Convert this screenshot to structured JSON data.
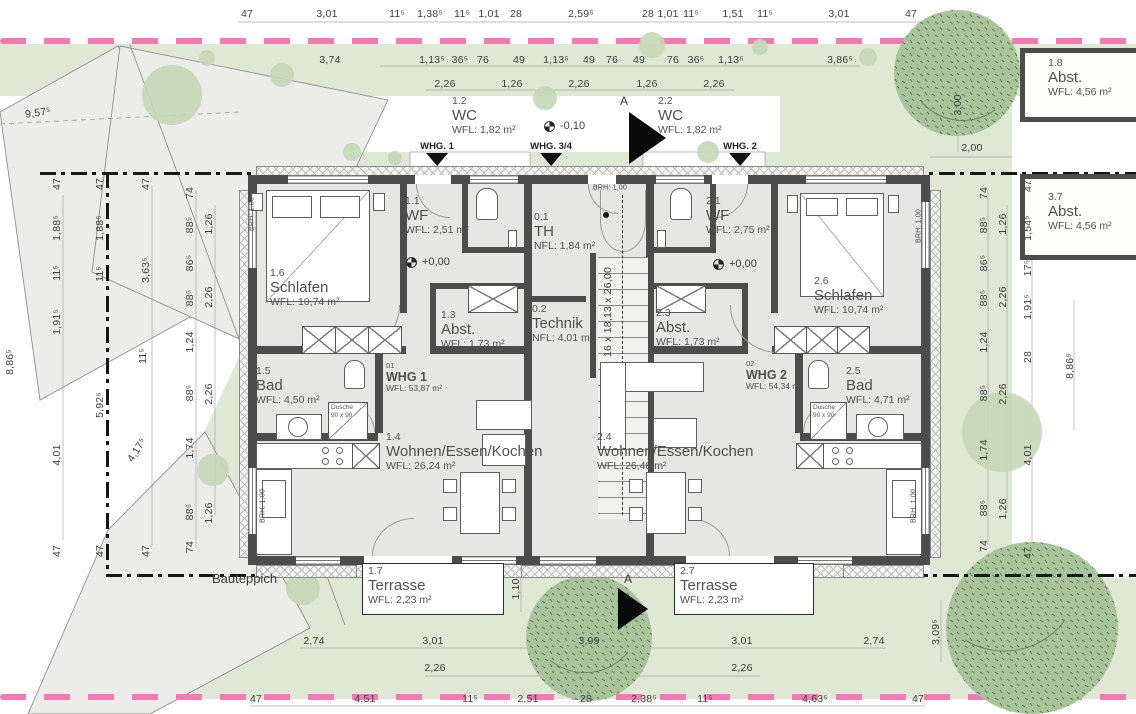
{
  "site": {
    "bauteppich": "Bauteppich",
    "colors": {
      "boundary_pink": "#f479b4",
      "site_green": "#dfe8d5",
      "tree_green": "#a9c49c",
      "wall_gray": "#4c4c4c",
      "floor_gray": "#e6e6e4"
    }
  },
  "stair_note": {
    "t": "16 x 18,13 x 26,00",
    "x": 608,
    "y": 312
  },
  "rooms": [
    {
      "num": "1.2",
      "name": "WC",
      "area": "WFL: 1,82 m²",
      "x": 452,
      "y": 96
    },
    {
      "num": "2.2",
      "name": "WC",
      "area": "WFL: 1,82 m²",
      "x": 658,
      "y": 96
    },
    {
      "num": "1.1",
      "name": "WF",
      "area": "WFL: 2,51 m²",
      "x": 405,
      "y": 196
    },
    {
      "num": "2.1",
      "name": "WF",
      "area": "WFL: 2,75 m²",
      "x": 706,
      "y": 196
    },
    {
      "num": "0.1",
      "name": "TH",
      "area": "NFL: 1,84 m²",
      "x": 534,
      "y": 212
    },
    {
      "num": "1.6",
      "name": "Schlafen",
      "area": "WFL: 10,74 m²",
      "x": 270,
      "y": 268
    },
    {
      "num": "2.6",
      "name": "Schlafen",
      "area": "WFL: 10,74 m²",
      "x": 814,
      "y": 276
    },
    {
      "num": "1.3",
      "name": "Abst.",
      "area": "WFL: 1,73 m²",
      "x": 441,
      "y": 310
    },
    {
      "num": "2.3",
      "name": "Abst.",
      "area": "WFL: 1,73 m²",
      "x": 656,
      "y": 308
    },
    {
      "num": "0.2",
      "name": "Technik",
      "area": "NFL: 4,01 m²",
      "x": 532,
      "y": 304
    },
    {
      "num": "1.5",
      "name": "Bad",
      "area": "WFL: 4,50 m²",
      "x": 256,
      "y": 366
    },
    {
      "num": "2.5",
      "name": "Bad",
      "area": "WFL: 4,71 m²",
      "x": 846,
      "y": 366
    },
    {
      "num": "1.4",
      "name": "Wohnen/Essen/Kochen",
      "area": "WFL: 26,24 m²",
      "x": 386,
      "y": 432
    },
    {
      "num": "2.4",
      "name": "Wohnen/Essen/Kochen",
      "area": "WFL: 26,48 m²",
      "x": 597,
      "y": 432
    },
    {
      "num": "1.7",
      "name": "Terrasse",
      "area": "WFL: 2,23 m²",
      "x": 368,
      "y": 566
    },
    {
      "num": "2.7",
      "name": "Terrasse",
      "area": "WFL: 2,23 m²",
      "x": 680,
      "y": 566
    },
    {
      "num": "1.8",
      "name": "Abst.",
      "area": "WFL: 4,56 m²",
      "x": 1048,
      "y": 58
    },
    {
      "num": "3.7",
      "name": "Abst.",
      "area": "WFL: 4,56 m²",
      "x": 1048,
      "y": 192
    },
    {
      "num": "01",
      "name": "WHG 1",
      "area": "WFL: 53,87 m²",
      "x": 386,
      "y": 362,
      "style": "unit"
    },
    {
      "num": "02",
      "name": "WHG 2",
      "area": "WFL: 54,34 m²",
      "x": 746,
      "y": 360,
      "style": "unit"
    }
  ],
  "benchmarks": [
    {
      "t": "+0,00",
      "x": 406,
      "y": 256
    },
    {
      "t": "+0,00",
      "x": 713,
      "y": 258
    },
    {
      "t": "-0,10",
      "x": 544,
      "y": 120
    }
  ],
  "entries": [
    {
      "t": "WHG. 1",
      "x": 437,
      "y": 141
    },
    {
      "t": "WHG. 3/4",
      "x": 551,
      "y": 141
    },
    {
      "t": "WHG. 2",
      "x": 740,
      "y": 141
    }
  ],
  "sections": [
    {
      "t": "A",
      "x": 620,
      "y": 94,
      "tx": 629,
      "ty": 112,
      "tw": 37,
      "th": 52
    },
    {
      "t": "A",
      "x": 624,
      "y": 572,
      "tx": 618,
      "ty": 588,
      "tw": 30,
      "th": 42
    }
  ],
  "showers": [
    {
      "l1": "Dusche",
      "l2": "90 x 90",
      "x": 328,
      "y": 402,
      "w": 40,
      "h": 38
    },
    {
      "l1": "Dusche",
      "l2": "90 x 90",
      "x": 810,
      "y": 402,
      "w": 37,
      "h": 38
    }
  ],
  "dims": [
    {
      "t": "47",
      "x": 247,
      "y": 14
    },
    {
      "t": "3,01",
      "x": 327,
      "y": 14
    },
    {
      "t": "11⁵",
      "x": 397,
      "y": 14
    },
    {
      "t": "1,38⁵",
      "x": 430,
      "y": 14
    },
    {
      "t": "11⁵",
      "x": 462,
      "y": 14
    },
    {
      "t": "1,01",
      "x": 489,
      "y": 14
    },
    {
      "t": "28",
      "x": 516,
      "y": 14
    },
    {
      "t": "2,59⁵",
      "x": 581,
      "y": 14
    },
    {
      "t": "28",
      "x": 648,
      "y": 14
    },
    {
      "t": "1,01",
      "x": 668,
      "y": 14
    },
    {
      "t": "11⁵",
      "x": 691,
      "y": 14
    },
    {
      "t": "1,51",
      "x": 733,
      "y": 14
    },
    {
      "t": "11⁵",
      "x": 765,
      "y": 14
    },
    {
      "t": "3,01",
      "x": 839,
      "y": 14
    },
    {
      "t": "47",
      "x": 911,
      "y": 14
    },
    {
      "t": "3,74",
      "x": 330,
      "y": 60
    },
    {
      "t": "1,13⁵",
      "x": 432,
      "y": 60
    },
    {
      "t": "36⁵",
      "x": 460,
      "y": 60
    },
    {
      "t": "76",
      "x": 483,
      "y": 60
    },
    {
      "t": "49",
      "x": 519,
      "y": 60
    },
    {
      "t": "1,13⁵",
      "x": 556,
      "y": 60
    },
    {
      "t": "49",
      "x": 589,
      "y": 60
    },
    {
      "t": "76",
      "x": 612,
      "y": 60
    },
    {
      "t": "49",
      "x": 639,
      "y": 60
    },
    {
      "t": "76",
      "x": 673,
      "y": 60
    },
    {
      "t": "36⁵",
      "x": 696,
      "y": 60
    },
    {
      "t": "1,13⁵",
      "x": 731,
      "y": 60
    },
    {
      "t": "3,86⁵",
      "x": 840,
      "y": 60
    },
    {
      "t": "2,26",
      "x": 445,
      "y": 84
    },
    {
      "t": "1,26",
      "x": 512,
      "y": 84
    },
    {
      "t": "2,26",
      "x": 579,
      "y": 84
    },
    {
      "t": "1,26",
      "x": 647,
      "y": 84
    },
    {
      "t": "2,26",
      "x": 714,
      "y": 84
    },
    {
      "t": "3,00",
      "x": 958,
      "y": 105,
      "r": -90
    },
    {
      "t": "2,00",
      "x": 972,
      "y": 148
    },
    {
      "t": "9,57⁵",
      "x": 38,
      "y": 113,
      "r": -8
    },
    {
      "t": "8,86⁵",
      "x": 10,
      "y": 362,
      "r": -90
    },
    {
      "t": "47",
      "x": 57,
      "y": 184,
      "r": -90
    },
    {
      "t": "1,88⁵",
      "x": 57,
      "y": 228,
      "r": -90
    },
    {
      "t": "11⁵",
      "x": 57,
      "y": 273,
      "r": -90
    },
    {
      "t": "1,91⁵",
      "x": 57,
      "y": 322,
      "r": -90
    },
    {
      "t": "4,01",
      "x": 57,
      "y": 455,
      "r": -90
    },
    {
      "t": "47",
      "x": 57,
      "y": 551,
      "r": -90
    },
    {
      "t": "47",
      "x": 100,
      "y": 184,
      "r": -90
    },
    {
      "t": "1,88⁵",
      "x": 100,
      "y": 228,
      "r": -90
    },
    {
      "t": "11⁵",
      "x": 100,
      "y": 274,
      "r": -90
    },
    {
      "t": "5,92⁵",
      "x": 100,
      "y": 405,
      "r": -90
    },
    {
      "t": "47",
      "x": 100,
      "y": 551,
      "r": -90
    },
    {
      "t": "47",
      "x": 146,
      "y": 184,
      "r": -90
    },
    {
      "t": "3,63⁵",
      "x": 146,
      "y": 270,
      "r": -90
    },
    {
      "t": "11⁵",
      "x": 143,
      "y": 356,
      "r": -90
    },
    {
      "t": "4,17⁵",
      "x": 137,
      "y": 450,
      "r": -57
    },
    {
      "t": "47",
      "x": 146,
      "y": 551,
      "r": -90
    },
    {
      "t": "74",
      "x": 190,
      "y": 193,
      "r": -90
    },
    {
      "t": "88⁵",
      "x": 190,
      "y": 225,
      "r": -90
    },
    {
      "t": "86⁵",
      "x": 190,
      "y": 263,
      "r": -90
    },
    {
      "t": "88⁵",
      "x": 190,
      "y": 298,
      "r": -90
    },
    {
      "t": "1,24",
      "x": 190,
      "y": 342,
      "r": -90
    },
    {
      "t": "88⁵",
      "x": 190,
      "y": 393,
      "r": -90
    },
    {
      "t": "1,74",
      "x": 190,
      "y": 448,
      "r": -90
    },
    {
      "t": "88⁵",
      "x": 190,
      "y": 512,
      "r": -90
    },
    {
      "t": "74",
      "x": 190,
      "y": 547,
      "r": -90
    },
    {
      "t": "1,26",
      "x": 209,
      "y": 224,
      "r": -90
    },
    {
      "t": "2,26",
      "x": 209,
      "y": 297,
      "r": -90
    },
    {
      "t": "2,26",
      "x": 209,
      "y": 394,
      "r": -90
    },
    {
      "t": "1,26",
      "x": 209,
      "y": 513,
      "r": -90
    },
    {
      "t": "74",
      "x": 984,
      "y": 193,
      "r": -90
    },
    {
      "t": "88⁵",
      "x": 984,
      "y": 225,
      "r": -90
    },
    {
      "t": "86⁵",
      "x": 984,
      "y": 263,
      "r": -90
    },
    {
      "t": "88⁵",
      "x": 984,
      "y": 298,
      "r": -90
    },
    {
      "t": "1,24",
      "x": 984,
      "y": 342,
      "r": -90
    },
    {
      "t": "88⁵",
      "x": 984,
      "y": 393,
      "r": -90
    },
    {
      "t": "1,74",
      "x": 984,
      "y": 450,
      "r": -90
    },
    {
      "t": "88⁵",
      "x": 984,
      "y": 508,
      "r": -90
    },
    {
      "t": "74",
      "x": 984,
      "y": 546,
      "r": -90
    },
    {
      "t": "1,26",
      "x": 1003,
      "y": 224,
      "r": -90
    },
    {
      "t": "2,26",
      "x": 1003,
      "y": 297,
      "r": -90
    },
    {
      "t": "2,26",
      "x": 1003,
      "y": 394,
      "r": -90
    },
    {
      "t": "1,26",
      "x": 1003,
      "y": 509,
      "r": -90
    },
    {
      "t": "47",
      "x": 1028,
      "y": 186,
      "r": -90
    },
    {
      "t": "1,54⁵",
      "x": 1028,
      "y": 228,
      "r": -90
    },
    {
      "t": "17⁵",
      "x": 1028,
      "y": 268,
      "r": -90
    },
    {
      "t": "1,91⁵",
      "x": 1028,
      "y": 307,
      "r": -90
    },
    {
      "t": "28",
      "x": 1028,
      "y": 357,
      "r": -90
    },
    {
      "t": "4,01",
      "x": 1028,
      "y": 455,
      "r": -90
    },
    {
      "t": "47",
      "x": 1028,
      "y": 553,
      "r": -90
    },
    {
      "t": "8,86⁵",
      "x": 1070,
      "y": 366,
      "r": -90
    },
    {
      "t": "3,09⁵",
      "x": 936,
      "y": 632,
      "r": -90
    },
    {
      "t": "2,74",
      "x": 314,
      "y": 641
    },
    {
      "t": "3,01",
      "x": 433,
      "y": 641
    },
    {
      "t": "3,99",
      "x": 589,
      "y": 641
    },
    {
      "t": "3,01",
      "x": 742,
      "y": 641
    },
    {
      "t": "2,74",
      "x": 874,
      "y": 641
    },
    {
      "t": "2,26",
      "x": 435,
      "y": 668
    },
    {
      "t": "2,26",
      "x": 742,
      "y": 668
    },
    {
      "t": "47",
      "x": 256,
      "y": 699
    },
    {
      "t": "4,51",
      "x": 365,
      "y": 699
    },
    {
      "t": "11⁵",
      "x": 470,
      "y": 699
    },
    {
      "t": "2,51",
      "x": 528,
      "y": 699
    },
    {
      "t": "28",
      "x": 586,
      "y": 699
    },
    {
      "t": "2,38⁵",
      "x": 644,
      "y": 699
    },
    {
      "t": "11⁵",
      "x": 705,
      "y": 699
    },
    {
      "t": "4,63⁵",
      "x": 815,
      "y": 699
    },
    {
      "t": "47",
      "x": 918,
      "y": 699
    },
    {
      "t": "1,10",
      "x": 516,
      "y": 589,
      "r": -90
    },
    {
      "t": "BRH: 1,00",
      "x": 252,
      "y": 214,
      "r": -90,
      "s": 1
    },
    {
      "t": "BRH: 1,00",
      "x": 263,
      "y": 506,
      "r": -90,
      "s": 1
    },
    {
      "t": "BRH: 1,00",
      "x": 919,
      "y": 226,
      "r": -90,
      "s": 1
    },
    {
      "t": "BRH: 1,00",
      "x": 914,
      "y": 506,
      "r": -90,
      "s": 1
    },
    {
      "t": "BRH: 1,00",
      "x": 610,
      "y": 188,
      "s": 1
    }
  ]
}
